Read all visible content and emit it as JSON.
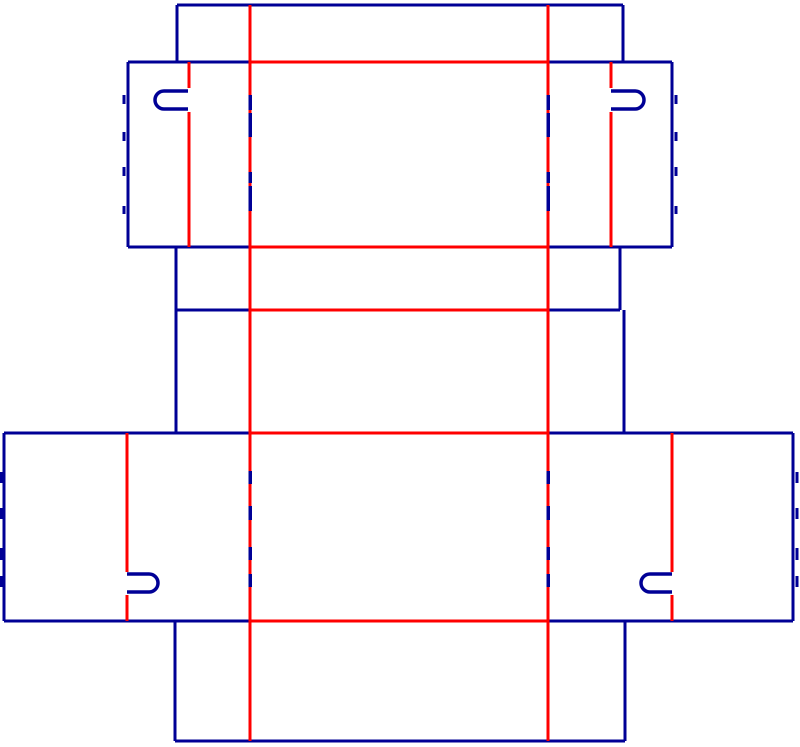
{
  "canvas": {
    "width": 800,
    "height": 747,
    "background": "#ffffff"
  },
  "colors": {
    "cut": "#000096",
    "crease": "#ff0000"
  },
  "stroke_widths": {
    "cut": 3,
    "crease": 3,
    "dash": 3.5,
    "tick": 3,
    "hook": 3.5
  },
  "layers": {
    "cut_lines": [
      [
        177,
        5,
        623,
        5
      ],
      [
        177,
        5,
        177,
        62
      ],
      [
        623,
        5,
        623,
        62
      ],
      [
        128,
        62,
        250,
        62
      ],
      [
        548,
        62,
        672,
        62
      ],
      [
        128,
        62,
        128,
        247
      ],
      [
        672,
        62,
        672,
        247
      ],
      [
        128,
        247,
        250,
        247
      ],
      [
        548,
        247,
        672,
        247
      ],
      [
        176,
        247,
        176,
        433
      ],
      [
        620,
        247,
        620,
        310
      ],
      [
        176,
        310,
        250,
        310
      ],
      [
        548,
        310,
        620,
        310
      ],
      [
        624,
        310,
        624,
        433
      ],
      [
        4,
        433,
        250,
        433
      ],
      [
        548,
        433,
        793,
        433
      ],
      [
        4,
        433,
        4,
        621
      ],
      [
        793,
        433,
        793,
        621
      ],
      [
        4,
        621,
        250,
        621
      ],
      [
        548,
        621,
        793,
        621
      ],
      [
        175,
        621,
        175,
        741
      ],
      [
        625,
        621,
        625,
        741
      ],
      [
        175,
        741,
        625,
        741
      ]
    ],
    "crease_lines": [
      [
        250,
        5,
        250,
        741
      ],
      [
        548,
        5,
        548,
        741
      ],
      [
        250,
        62,
        548,
        62
      ],
      [
        250,
        247,
        548,
        247
      ],
      [
        250,
        310,
        548,
        310
      ],
      [
        250,
        433,
        548,
        433
      ],
      [
        250,
        621,
        548,
        621
      ],
      [
        189,
        62,
        189,
        88
      ],
      [
        189,
        112,
        189,
        247
      ],
      [
        611,
        62,
        611,
        88
      ],
      [
        611,
        112,
        611,
        247
      ],
      [
        127,
        433,
        127,
        572
      ],
      [
        127,
        595,
        127,
        621
      ],
      [
        672,
        433,
        672,
        572
      ],
      [
        672,
        595,
        672,
        621
      ]
    ],
    "cut_dashes": [
      [
        250,
        95,
        250,
        110
      ],
      [
        250,
        113,
        250,
        137
      ],
      [
        250,
        172,
        250,
        183
      ],
      [
        250,
        186,
        250,
        211
      ],
      [
        548,
        95,
        548,
        110
      ],
      [
        548,
        113,
        548,
        137
      ],
      [
        548,
        172,
        548,
        183
      ],
      [
        548,
        186,
        548,
        211
      ],
      [
        250,
        471,
        250,
        484
      ],
      [
        250,
        506,
        250,
        520
      ],
      [
        250,
        547,
        250,
        560
      ],
      [
        250,
        574,
        250,
        587
      ],
      [
        548,
        471,
        548,
        484
      ],
      [
        548,
        506,
        548,
        520
      ],
      [
        548,
        547,
        548,
        560
      ],
      [
        548,
        574,
        548,
        587
      ]
    ],
    "perforation_ticks": [
      [
        124,
        95,
        124,
        104
      ],
      [
        124,
        132,
        124,
        141
      ],
      [
        124,
        167,
        124,
        176
      ],
      [
        124,
        206,
        124,
        214
      ],
      [
        676,
        95,
        676,
        104
      ],
      [
        676,
        132,
        676,
        141
      ],
      [
        676,
        167,
        676,
        176
      ],
      [
        676,
        206,
        676,
        214
      ],
      [
        1,
        472,
        1,
        483
      ],
      [
        1,
        508,
        1,
        519
      ],
      [
        1,
        548,
        1,
        560
      ],
      [
        1,
        576,
        1,
        587
      ],
      [
        797,
        472,
        797,
        483
      ],
      [
        797,
        508,
        797,
        519
      ],
      [
        797,
        548,
        797,
        560
      ],
      [
        797,
        576,
        797,
        587
      ]
    ],
    "hook_cutouts": [
      "M188 91 L164 91 A9 9 0 0 0 164 109 L188 109",
      "M611 91 L635 91 A9 9 0 0 1 635 109 L611 109",
      "M127 574 L149 574 A9 9 0 0 1 149 592 L127 592",
      "M672 574 L650 574 A9 9 0 0 0 650 592 L672 592"
    ]
  }
}
